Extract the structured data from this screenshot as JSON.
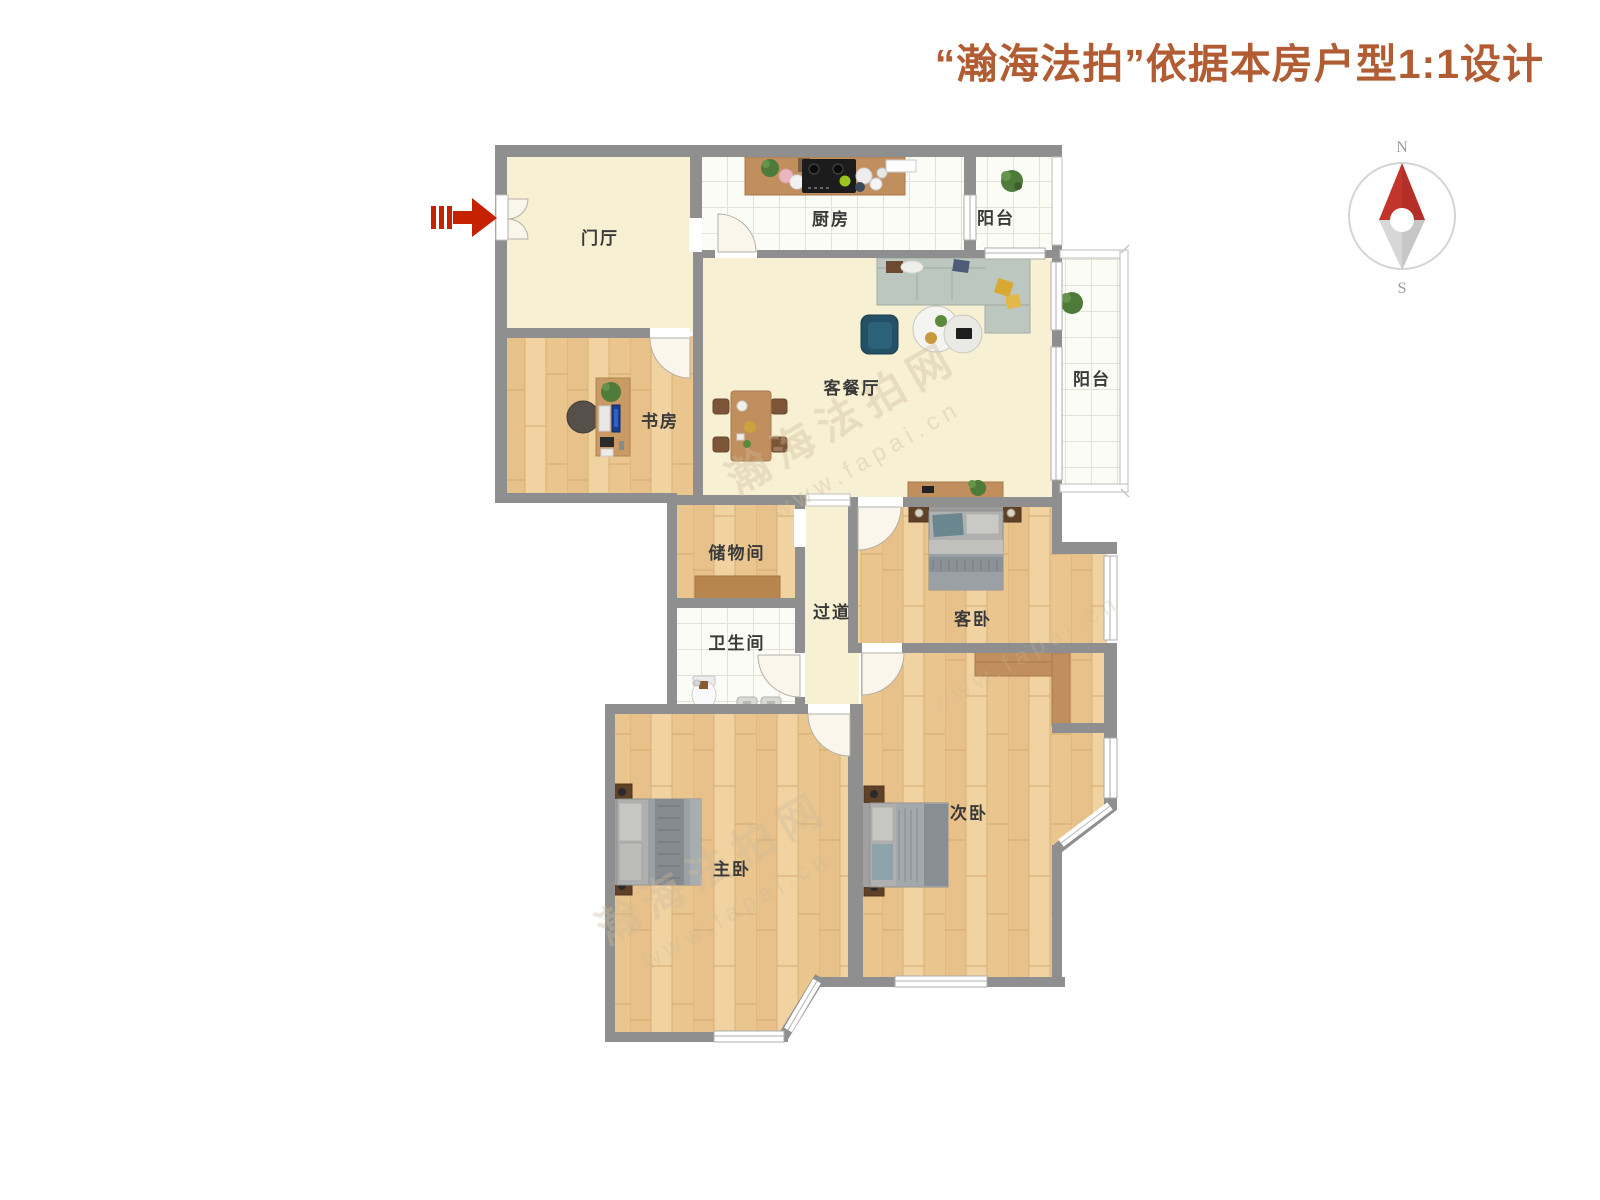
{
  "title": {
    "text": "“瀚海法拍”依据本房户型1:1设计",
    "color": "#b15c33"
  },
  "compass": {
    "north": "N",
    "south": "S"
  },
  "entry_arrow": {
    "color": "#c62100",
    "direction": "right"
  },
  "watermark": {
    "name": "瀚海法拍网",
    "url": "www.fapai.cn"
  },
  "rooms": [
    {
      "id": "entry-hall",
      "label": "门厅"
    },
    {
      "id": "kitchen",
      "label": "厨房"
    },
    {
      "id": "balcony-north",
      "label": "阳台"
    },
    {
      "id": "living-dining",
      "label": "客餐厅"
    },
    {
      "id": "study",
      "label": "书房"
    },
    {
      "id": "balcony-east",
      "label": "阳台"
    },
    {
      "id": "storage",
      "label": "储物间"
    },
    {
      "id": "hallway",
      "label": "过道"
    },
    {
      "id": "bathroom",
      "label": "卫生间"
    },
    {
      "id": "guest-bedroom",
      "label": "客卧"
    },
    {
      "id": "master-bedroom",
      "label": "主卧"
    },
    {
      "id": "second-bedroom",
      "label": "次卧"
    }
  ],
  "palette": {
    "wall": "#8f8f8f",
    "wood_floor": "#edca94",
    "cream_floor": "#f7f0d2",
    "tile_floor": "#fcfcf6",
    "compass_north": "#c2342c",
    "title_accent": "#b15c33"
  }
}
